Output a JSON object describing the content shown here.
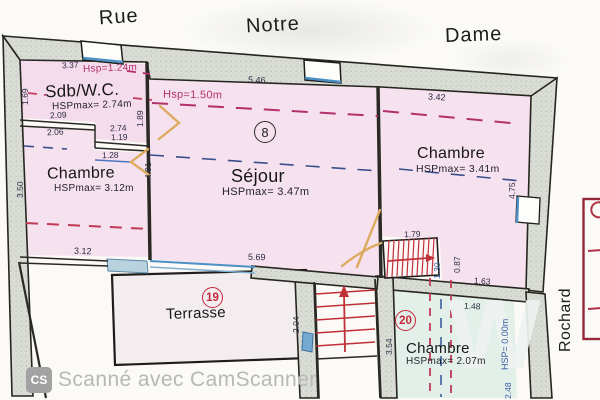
{
  "streets": {
    "rue": "Rue",
    "notre": "Notre",
    "dame": "Dame",
    "rochard": "Rochard"
  },
  "rooms": {
    "sdb": {
      "name": "Sdb/W.C.",
      "hspmax": "HSPmax= 2.74m",
      "hsp": "Hsp=1.24m"
    },
    "chambre_left": {
      "name": "Chambre",
      "hspmax": "HSPmax= 3.12m"
    },
    "sejour": {
      "name": "Séjour",
      "hspmax": "HSPmax= 3.47m",
      "hsp": "Hsp=1.50m",
      "number": "8"
    },
    "chambre_right": {
      "name": "Chambre",
      "hspmax": "HSPmax= 3.41m"
    },
    "terrasse": {
      "name": "Terrasse",
      "number": "19"
    },
    "chambre_bottom": {
      "name": "Chambre",
      "hspmax": "HSPmax= 2.07m",
      "number": "20",
      "hsp_floor": "HSP= 0.00m"
    }
  },
  "dimensions": {
    "sdb_top": "3.37",
    "sdb_left": "1.69",
    "wall_a": "2.09",
    "wall_b": "2.06",
    "pass_a": "2.74",
    "pass_b": "1.19",
    "pass_c": "1.28",
    "sejour_top": "5.46",
    "sejour_left_a": "1.89",
    "sejour_left_b": "4.91",
    "sejour_bottom": "5.69",
    "chl_left": "3.50",
    "chl_bottom": "3.12",
    "chr_top": "3.42",
    "chr_right": "4.75",
    "stair_top": "1.79",
    "stair_v1": "1.30",
    "stair_v2": "0.87",
    "low_a": "1.63",
    "low_b": "1.48",
    "terrasse_right": "2.04",
    "chb_left": "3.54",
    "chb_right": "2.48"
  },
  "watermark": {
    "logo": "CS",
    "text": "Scanné avec CamScanner",
    "big_letter": "W"
  },
  "colors": {
    "room_pink": "#f6e1ef",
    "room_cyan": "#e3f0ea",
    "terrasse_fill": "#f4edf0",
    "wall_gray": "#d9ddd6",
    "line_black": "#26251f",
    "stair_red": "#c03038",
    "hsp_magenta": "#b3306a",
    "dash_navy": "#3a4f8c",
    "window_blue": "#4a90c4",
    "door_orange": "#ddab60",
    "circle_red": "#c3273a",
    "legend_darkred": "#952739",
    "watermark_gray": "#b7b7b7"
  }
}
